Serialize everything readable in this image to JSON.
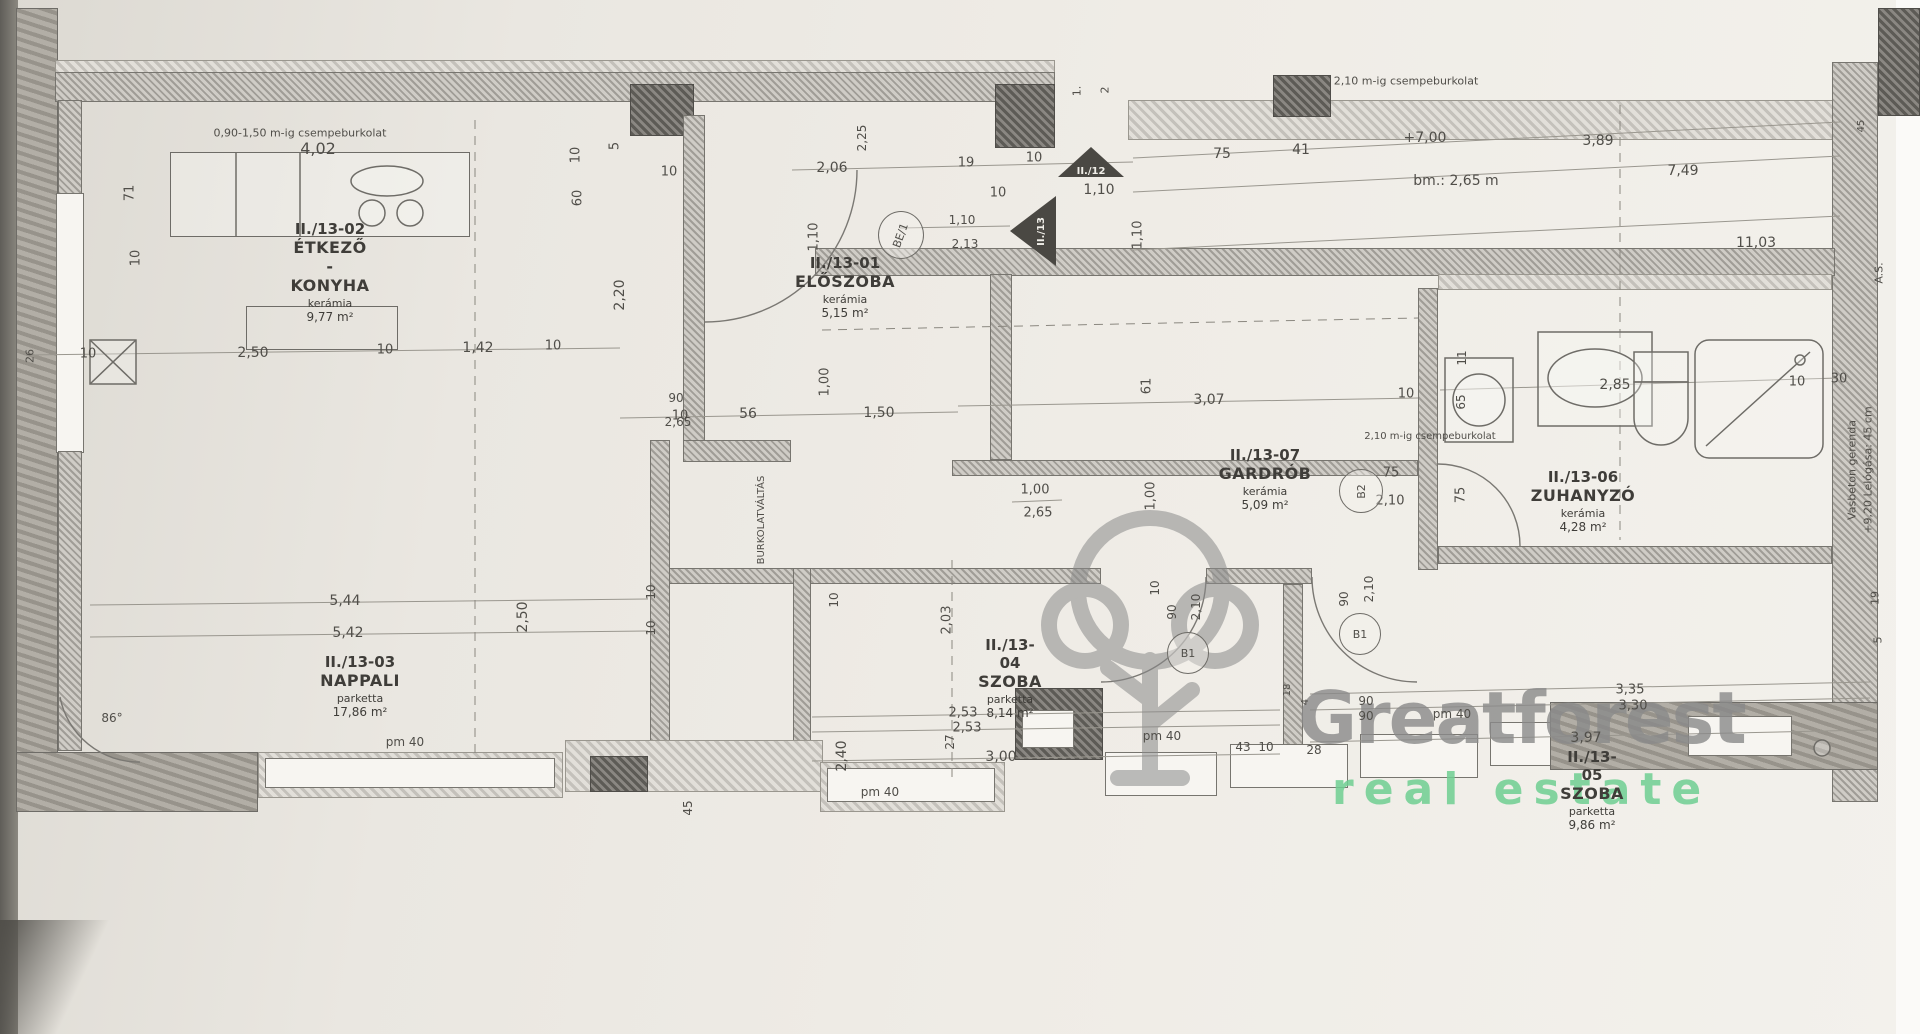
{
  "watermark": {
    "brand": "Greatforest",
    "sub": "real estate",
    "brand_color": "#8a8a8a",
    "sub_color": "#6fcf92",
    "logo": "tree-icon"
  },
  "rooms": [
    {
      "id": "II./13-01",
      "name": "ELŐSZOBA",
      "floor": "kerámia",
      "area": "5,15 m²",
      "cx": 845,
      "cy": 254
    },
    {
      "id": "II./13-02",
      "name": "ÉTKEZŐ - KONYHA",
      "floor": "kerámia",
      "area": "9,77 m²",
      "cx": 330,
      "cy": 220
    },
    {
      "id": "II./13-03",
      "name": "NAPPALI",
      "floor": "parketta",
      "area": "17,86 m²",
      "cx": 360,
      "cy": 653
    },
    {
      "id": "II./13-04",
      "name": "SZOBA",
      "floor": "parketta",
      "area": "8,14 m²",
      "cx": 1010,
      "cy": 636
    },
    {
      "id": "II./13-05",
      "name": "SZOBA",
      "floor": "parketta",
      "area": "9,86 m²",
      "cx": 1592,
      "cy": 748
    },
    {
      "id": "II./13-06",
      "name": "ZUHANYZÓ",
      "floor": "kerámia",
      "area": "4,28 m²",
      "cx": 1583,
      "cy": 468
    },
    {
      "id": "II./13-07",
      "name": "GARDRÓB",
      "floor": "kerámia",
      "area": "5,09 m²",
      "cx": 1265,
      "cy": 446
    }
  ],
  "door_tags": [
    {
      "t": "BE/1",
      "x": 878,
      "y": 211,
      "w": 44,
      "h": 46,
      "r": -70
    },
    {
      "t": "B1",
      "x": 1167,
      "y": 632,
      "w": 40,
      "h": 40,
      "r": 0
    },
    {
      "t": "B1",
      "x": 1339,
      "y": 613,
      "w": 40,
      "h": 40,
      "r": 0
    },
    {
      "t": "B2",
      "x": 1339,
      "y": 469,
      "w": 42,
      "h": 42,
      "r": -90
    }
  ],
  "level_triangles": [
    {
      "t": "II./12",
      "x": 1058,
      "y": 147,
      "w": 66,
      "h": 30,
      "dir": "up"
    },
    {
      "t": "II./13",
      "x": 1010,
      "y": 196,
      "w": 46,
      "h": 70,
      "dir": "left"
    }
  ],
  "annotations": [
    {
      "t": "0,90-1,50 m-ig csempeburkolat",
      "x": 300,
      "y": 133,
      "s": 11
    },
    {
      "t": "4,02",
      "x": 318,
      "y": 149,
      "s": 16
    },
    {
      "t": "71",
      "x": 130,
      "y": 193,
      "r": -90,
      "s": 13
    },
    {
      "t": "10",
      "x": 136,
      "y": 258,
      "r": -90,
      "s": 13
    },
    {
      "t": "26",
      "x": 30,
      "y": 356,
      "r": -90,
      "s": 11
    },
    {
      "t": "10",
      "x": 88,
      "y": 354,
      "s": 13
    },
    {
      "t": "2,50",
      "x": 253,
      "y": 353,
      "s": 14
    },
    {
      "t": "10",
      "x": 385,
      "y": 350,
      "s": 13
    },
    {
      "t": "1,42",
      "x": 478,
      "y": 348,
      "s": 14
    },
    {
      "t": "10",
      "x": 553,
      "y": 346,
      "s": 13
    },
    {
      "t": "10",
      "x": 680,
      "y": 416,
      "s": 13
    },
    {
      "t": "56",
      "x": 748,
      "y": 414,
      "s": 14
    },
    {
      "t": "10",
      "x": 576,
      "y": 155,
      "r": -90,
      "s": 13
    },
    {
      "t": "5",
      "x": 615,
      "y": 146,
      "r": -90,
      "s": 13
    },
    {
      "t": "60",
      "x": 578,
      "y": 198,
      "r": -90,
      "s": 13
    },
    {
      "t": "2,20",
      "x": 620,
      "y": 295,
      "r": -90,
      "s": 14
    },
    {
      "t": "10",
      "x": 669,
      "y": 172,
      "s": 13
    },
    {
      "t": "2,25",
      "x": 862,
      "y": 138,
      "r": -90,
      "s": 12
    },
    {
      "t": "2,06",
      "x": 832,
      "y": 168,
      "s": 14
    },
    {
      "t": "1,10",
      "x": 814,
      "y": 237,
      "r": -90,
      "s": 13
    },
    {
      "t": "19",
      "x": 966,
      "y": 163,
      "s": 13
    },
    {
      "t": "10",
      "x": 1034,
      "y": 158,
      "s": 13
    },
    {
      "t": "10",
      "x": 998,
      "y": 193,
      "s": 13
    },
    {
      "t": "1,10",
      "x": 1099,
      "y": 190,
      "s": 14
    },
    {
      "t": "1,10",
      "x": 1138,
      "y": 235,
      "r": -90,
      "s": 13
    },
    {
      "t": "1,10",
      "x": 962,
      "y": 220,
      "s": 12
    },
    {
      "t": "2,13",
      "x": 965,
      "y": 244,
      "s": 12
    },
    {
      "t": "1.",
      "x": 1077,
      "y": 91,
      "r": -90,
      "s": 11
    },
    {
      "t": "2",
      "x": 1105,
      "y": 90,
      "r": -90,
      "s": 11
    },
    {
      "t": "75",
      "x": 1222,
      "y": 154,
      "s": 14
    },
    {
      "t": "41",
      "x": 1301,
      "y": 150,
      "s": 14
    },
    {
      "t": "+7,00",
      "x": 1425,
      "y": 138,
      "s": 14
    },
    {
      "t": "bm.: 2,65 m",
      "x": 1456,
      "y": 181,
      "s": 14
    },
    {
      "t": "2,10 m-ig csempeburkolat",
      "x": 1406,
      "y": 81,
      "s": 11
    },
    {
      "t": "3,89",
      "x": 1598,
      "y": 141,
      "s": 14
    },
    {
      "t": "7,49",
      "x": 1683,
      "y": 171,
      "s": 14
    },
    {
      "t": "11,03",
      "x": 1756,
      "y": 243,
      "s": 14
    },
    {
      "t": "45",
      "x": 1862,
      "y": 126,
      "r": -90,
      "s": 10
    },
    {
      "t": "1,50",
      "x": 879,
      "y": 413,
      "s": 14
    },
    {
      "t": "1,00",
      "x": 825,
      "y": 382,
      "r": -90,
      "s": 13
    },
    {
      "t": "90",
      "x": 676,
      "y": 398,
      "s": 12
    },
    {
      "t": "2,65",
      "x": 678,
      "y": 422,
      "s": 12
    },
    {
      "t": "BURKOLATVÁLTÁS",
      "x": 762,
      "y": 520,
      "r": -90,
      "s": 10
    },
    {
      "t": "1,00",
      "x": 1035,
      "y": 490,
      "s": 13
    },
    {
      "t": "2,65",
      "x": 1038,
      "y": 513,
      "s": 13
    },
    {
      "t": "1,00",
      "x": 1151,
      "y": 496,
      "r": -90,
      "s": 13
    },
    {
      "t": "10",
      "x": 1155,
      "y": 588,
      "r": -90,
      "s": 12
    },
    {
      "t": "61",
      "x": 1147,
      "y": 386,
      "r": -90,
      "s": 13
    },
    {
      "t": "3,07",
      "x": 1209,
      "y": 400,
      "s": 14
    },
    {
      "t": "10",
      "x": 1406,
      "y": 394,
      "s": 13
    },
    {
      "t": "11",
      "x": 1462,
      "y": 358,
      "r": -90,
      "s": 12
    },
    {
      "t": "65",
      "x": 1461,
      "y": 402,
      "r": -90,
      "s": 12
    },
    {
      "t": "2,85",
      "x": 1615,
      "y": 385,
      "s": 14
    },
    {
      "t": "10",
      "x": 1797,
      "y": 382,
      "s": 13
    },
    {
      "t": "30",
      "x": 1839,
      "y": 379,
      "s": 13
    },
    {
      "t": "2,10 m-ig csempeburkolat",
      "x": 1430,
      "y": 437,
      "s": 10
    },
    {
      "t": "75",
      "x": 1391,
      "y": 473,
      "s": 13
    },
    {
      "t": "2,10",
      "x": 1390,
      "y": 501,
      "s": 13
    },
    {
      "t": "75",
      "x": 1461,
      "y": 495,
      "r": -90,
      "s": 13
    },
    {
      "t": "90",
      "x": 1172,
      "y": 612,
      "r": -90,
      "s": 12
    },
    {
      "t": "2,10",
      "x": 1196,
      "y": 607,
      "r": -90,
      "s": 12
    },
    {
      "t": "90",
      "x": 1344,
      "y": 599,
      "r": -90,
      "s": 12
    },
    {
      "t": "2,10",
      "x": 1369,
      "y": 589,
      "r": -90,
      "s": 12
    },
    {
      "t": "2,03",
      "x": 947,
      "y": 620,
      "r": -90,
      "s": 13
    },
    {
      "t": "5,44",
      "x": 345,
      "y": 601,
      "s": 14
    },
    {
      "t": "5,42",
      "x": 348,
      "y": 633,
      "s": 14
    },
    {
      "t": "2,50",
      "x": 523,
      "y": 617,
      "r": -90,
      "s": 14
    },
    {
      "t": "10",
      "x": 651,
      "y": 592,
      "r": -90,
      "s": 12
    },
    {
      "t": "10",
      "x": 651,
      "y": 628,
      "r": -90,
      "s": 12
    },
    {
      "t": "2,40",
      "x": 842,
      "y": 756,
      "r": -90,
      "s": 14
    },
    {
      "t": "10",
      "x": 834,
      "y": 600,
      "r": -90,
      "s": 12
    },
    {
      "t": "2,53",
      "x": 963,
      "y": 713,
      "s": 13
    },
    {
      "t": "2,53",
      "x": 967,
      "y": 728,
      "s": 13
    },
    {
      "t": "3,00",
      "x": 1001,
      "y": 757,
      "s": 14
    },
    {
      "t": "43",
      "x": 1243,
      "y": 747,
      "s": 12
    },
    {
      "t": "10",
      "x": 1266,
      "y": 747,
      "s": 12
    },
    {
      "t": "28",
      "x": 1314,
      "y": 750,
      "s": 12
    },
    {
      "t": "90",
      "x": 1366,
      "y": 701,
      "s": 12
    },
    {
      "t": "90",
      "x": 1366,
      "y": 716,
      "s": 12
    },
    {
      "t": "18",
      "x": 1288,
      "y": 690,
      "r": -90,
      "s": 10
    },
    {
      "t": "4",
      "x": 1306,
      "y": 702,
      "r": -90,
      "s": 10
    },
    {
      "t": "27",
      "x": 950,
      "y": 742,
      "r": -90,
      "s": 12
    },
    {
      "t": "45",
      "x": 688,
      "y": 808,
      "r": -90,
      "s": 12
    },
    {
      "t": "86°",
      "x": 112,
      "y": 718,
      "s": 12
    },
    {
      "t": "3,35",
      "x": 1630,
      "y": 690,
      "s": 13
    },
    {
      "t": "3,30",
      "x": 1633,
      "y": 706,
      "s": 13
    },
    {
      "t": "3,97",
      "x": 1586,
      "y": 738,
      "s": 14
    },
    {
      "t": "5",
      "x": 1878,
      "y": 640,
      "r": -90,
      "s": 11
    },
    {
      "t": "19",
      "x": 1875,
      "y": 598,
      "r": -90,
      "s": 11
    },
    {
      "t": "pm 40",
      "x": 405,
      "y": 742,
      "s": 12
    },
    {
      "t": "pm 40",
      "x": 880,
      "y": 792,
      "s": 12
    },
    {
      "t": "pm 40",
      "x": 1162,
      "y": 736,
      "s": 12
    },
    {
      "t": "pm 40",
      "x": 1452,
      "y": 714,
      "s": 12
    },
    {
      "t": "Vasbeton gerenda",
      "x": 1852,
      "y": 470,
      "r": -90,
      "s": 11
    },
    {
      "t": "+9,20 Lelógása: 45 cm",
      "x": 1868,
      "y": 470,
      "r": -90,
      "s": 11
    },
    {
      "t": "A.S.",
      "x": 1879,
      "y": 273,
      "r": -90,
      "s": 11
    }
  ]
}
